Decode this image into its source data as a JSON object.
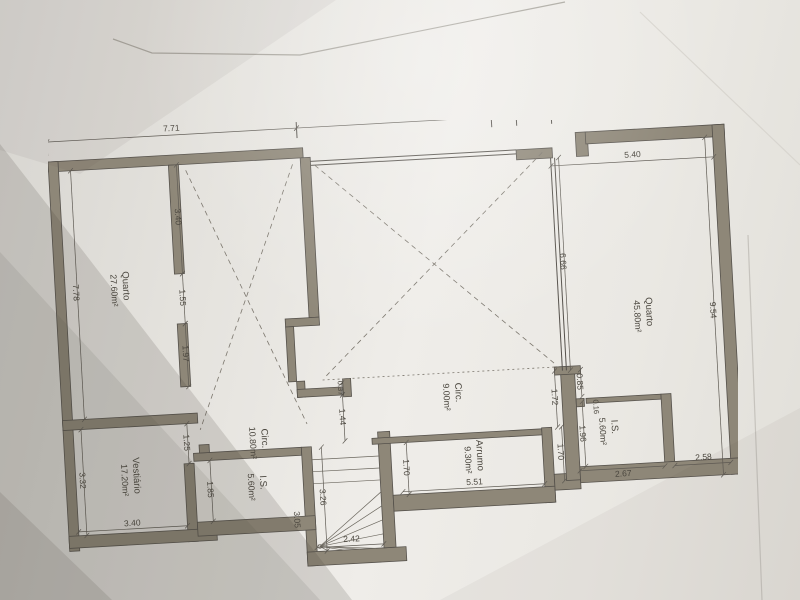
{
  "style": {
    "wall_color": "#8e8778",
    "wall_edge_color": "#55514b",
    "paper_color": "#e9e7e2",
    "line_color": "#5f5b54",
    "text_color": "#4b473f"
  },
  "plan": {
    "rooms": [
      {
        "id": "quarto-left",
        "name": "Quarto",
        "area": "27.60m²"
      },
      {
        "id": "quarto-right",
        "name": "Quarto",
        "area": "45.80m²"
      },
      {
        "id": "circ-upper",
        "name": "Circ.",
        "area": "9.00m²"
      },
      {
        "id": "circ-lower",
        "name": "Circ.",
        "area": "10.80m²"
      },
      {
        "id": "arrumo",
        "name": "Arrumo",
        "area": "9.30m²"
      },
      {
        "id": "is-right",
        "name": "I.S.",
        "area": "5.60m²"
      },
      {
        "id": "is-bottom",
        "name": "I.S.",
        "area": "5.60m²"
      },
      {
        "id": "vestiario",
        "name": "Vestiário",
        "area": "17.20m²"
      }
    ],
    "dims": {
      "top": [
        "7.71",
        "5.05",
        "1.10",
        "0.85",
        "4.21"
      ],
      "quarto_right_top": "5.40",
      "quarto_right_left": "6.66",
      "quarto_right_right": "9.54",
      "quarto_left_height": "7.78",
      "quarto_left_wall": [
        "3.40",
        "1.55",
        "1.97"
      ],
      "vestiario_height": "3.32",
      "vestiario_width": "3.40",
      "vestiario_door": "1.25",
      "is_bottom_height": "1.85",
      "is_bottom_width": "3.05",
      "stairs_width": "2.42",
      "stairs_length": "3.26",
      "circ_upper_step": "0.37",
      "circ_upper_left": "1.44",
      "circ_upper_height": "1.72",
      "arrumo_height": "1.70",
      "arrumo_width": "5.51",
      "corridor_height": "1.70",
      "is_right_top": "0.85",
      "is_right_wall": "0.16",
      "is_right_height": "1.96",
      "is_right_width": "2.67",
      "quarto_right_bottom": "2.58"
    }
  }
}
